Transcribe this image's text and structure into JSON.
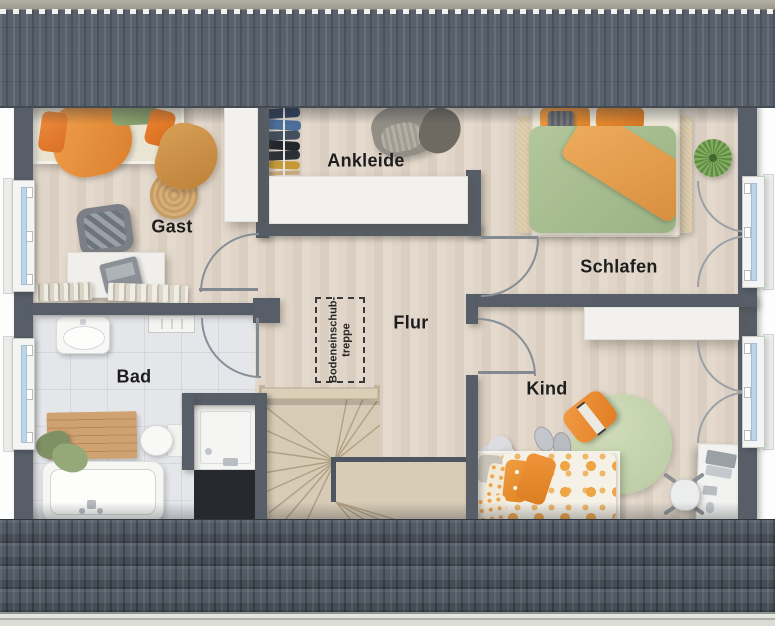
{
  "plan": {
    "rooms": {
      "gast": {
        "label": "Gast"
      },
      "ankleide": {
        "label": "Ankleide"
      },
      "schlafen": {
        "label": "Schlafen"
      },
      "flur": {
        "label": "Flur"
      },
      "bad": {
        "label": "Bad"
      },
      "kind": {
        "label": "Kind"
      }
    },
    "annotations": {
      "attic_hatch": {
        "line1": "Bodeneinschub-",
        "line2": "treppe"
      }
    },
    "colors": {
      "wall": "#575e68",
      "roof_tile": "#58616b",
      "roof_ridge": "#a7a49a",
      "eave_board": "#e3e4de",
      "floor_wood": "#ddd2c4",
      "floor_tile": "#e4e6ea",
      "stair_wood": "#d8cbb6",
      "window_glass": "#b9d6ea",
      "accent_orange": "#ee953f",
      "duvet_green": "#a9c193",
      "rug_green": "#c6d5b0",
      "rug_beige": "#d9c8a7",
      "shaft_dark": "#26292e"
    }
  }
}
